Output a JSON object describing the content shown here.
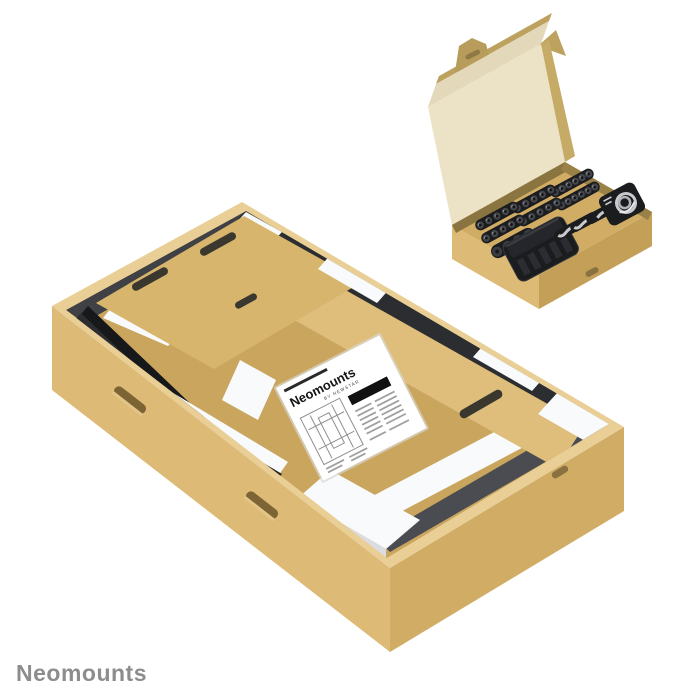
{
  "brand": {
    "label": "Neomounts",
    "color": "#8d8d8d"
  },
  "manual": {
    "title": "Neomounts",
    "subtitle": "BY NEWSTAR"
  },
  "colors": {
    "background": "#ffffff",
    "brand_text": "#8d8d8d",
    "wall_light": "#ddbb76",
    "wall": "#d0ac65",
    "wall_dark": "#c39f58",
    "rim": "#e9cf96",
    "floor": "#c9a55d",
    "panel": "#d8b56c",
    "panel_light": "#dfbe7c",
    "lid_inner": "#ece2c6",
    "lid_flap": "#e4d8ba",
    "lid_edge": "#bda15f",
    "foam": "#f9fafb",
    "foam_shade": "#dcdde2",
    "rail_black": "#2b2d30",
    "rail_deep": "#17181a",
    "slot_dark": "#3a372f",
    "recess_black": "#1b1c1e",
    "pocket_dark": "#26231f",
    "metal_silver": "#c8cace",
    "screw_body": "#45464b",
    "screw_hole": "#141416",
    "manual_paper": "#ffffff",
    "manual_ink": "#151515",
    "manual_gray": "#a0a0a0",
    "tray_shadow": "#8a7440"
  },
  "small_box": {
    "screw_rows": [
      6,
      6,
      5,
      5,
      5,
      5
    ],
    "washers": 4,
    "tools": 3
  }
}
